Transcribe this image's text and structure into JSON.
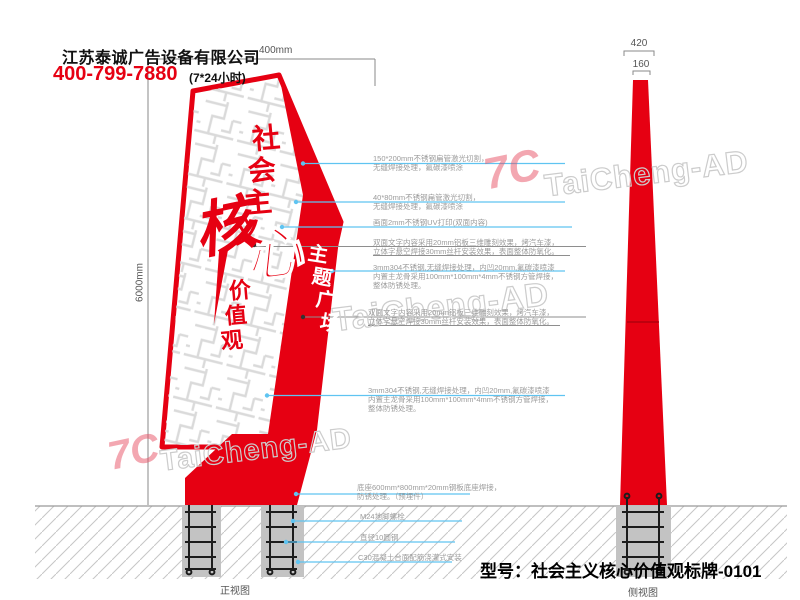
{
  "header": {
    "company": "江苏泰诚广告设备有限公司",
    "phone": "400-799-7880",
    "hours": "(7*24小时)"
  },
  "dimensions": {
    "top_width": "400mm",
    "height": "6000mm",
    "side_width": "420",
    "side_cap": "160"
  },
  "sign": {
    "title_chars": [
      "社",
      "会",
      "主",
      "义"
    ],
    "core_char_1": "核",
    "core_char_2": "心",
    "value_chars": [
      "价",
      "值",
      "观"
    ],
    "band_chars": [
      "主",
      "题",
      "广",
      "场"
    ]
  },
  "annotations": {
    "right": [
      {
        "l1": "150*200mm不锈钢扁管激光切割，",
        "l2": "无缝焊接处理，氟碳漆喷涂"
      },
      {
        "l1": "40*80mm不锈钢扁管激光切割，",
        "l2": "无缝焊接处理，氟碳漆喷涂"
      },
      {
        "l1": "画面2mm不锈钢UV打印(双面内容)"
      },
      {
        "l1": "双面文字内容采用20mm铝板三维雕刻效果，烤汽车漆，",
        "l2": "立体字悬空焊接30mm丝杆安装效果，表面整体防氧化。"
      },
      {
        "l1": "3mm304不锈钢,无缝焊接处理，内凹20mm,氟碳漆喷漆",
        "l2": "内置主龙骨采用100mm*100mm*4mm不锈钢方管焊接，",
        "l3": "整体防锈处理。"
      },
      {
        "l1": "双面文字内容采用20mm铝板三维雕刻效果，烤汽车漆，",
        "l2": "立体字悬空焊接30mm丝杆安装效果，表面整体防氧化。"
      },
      {
        "l1": "3mm304不锈钢,无缝焊接处理，内凹20mm,氟碳漆喷漆",
        "l2": "内置主龙骨采用100mm*100mm*4mm不锈钢方管焊接，",
        "l3": "整体防锈处理。"
      }
    ],
    "bottom": [
      {
        "l1": "底座600mm*800mm*20mm钢板底座焊接，",
        "l2": "防锈处理。（预埋件）"
      },
      {
        "l1": "M24地脚螺栓"
      },
      {
        "l1": "直径10圆钢"
      },
      {
        "l1": "C30混凝土台面配筋浇灌式安装"
      }
    ]
  },
  "views": {
    "front": "正视图",
    "side": "侧视图"
  },
  "model_line": "型号：社会主义核心价值观标牌-0101",
  "watermark": {
    "logo": "7C",
    "text": "TaiCheng-AD"
  },
  "colors": {
    "red": "#e60012",
    "leader_blue": "#5fc4f1",
    "annotation_gray": "#9b9b9b"
  }
}
